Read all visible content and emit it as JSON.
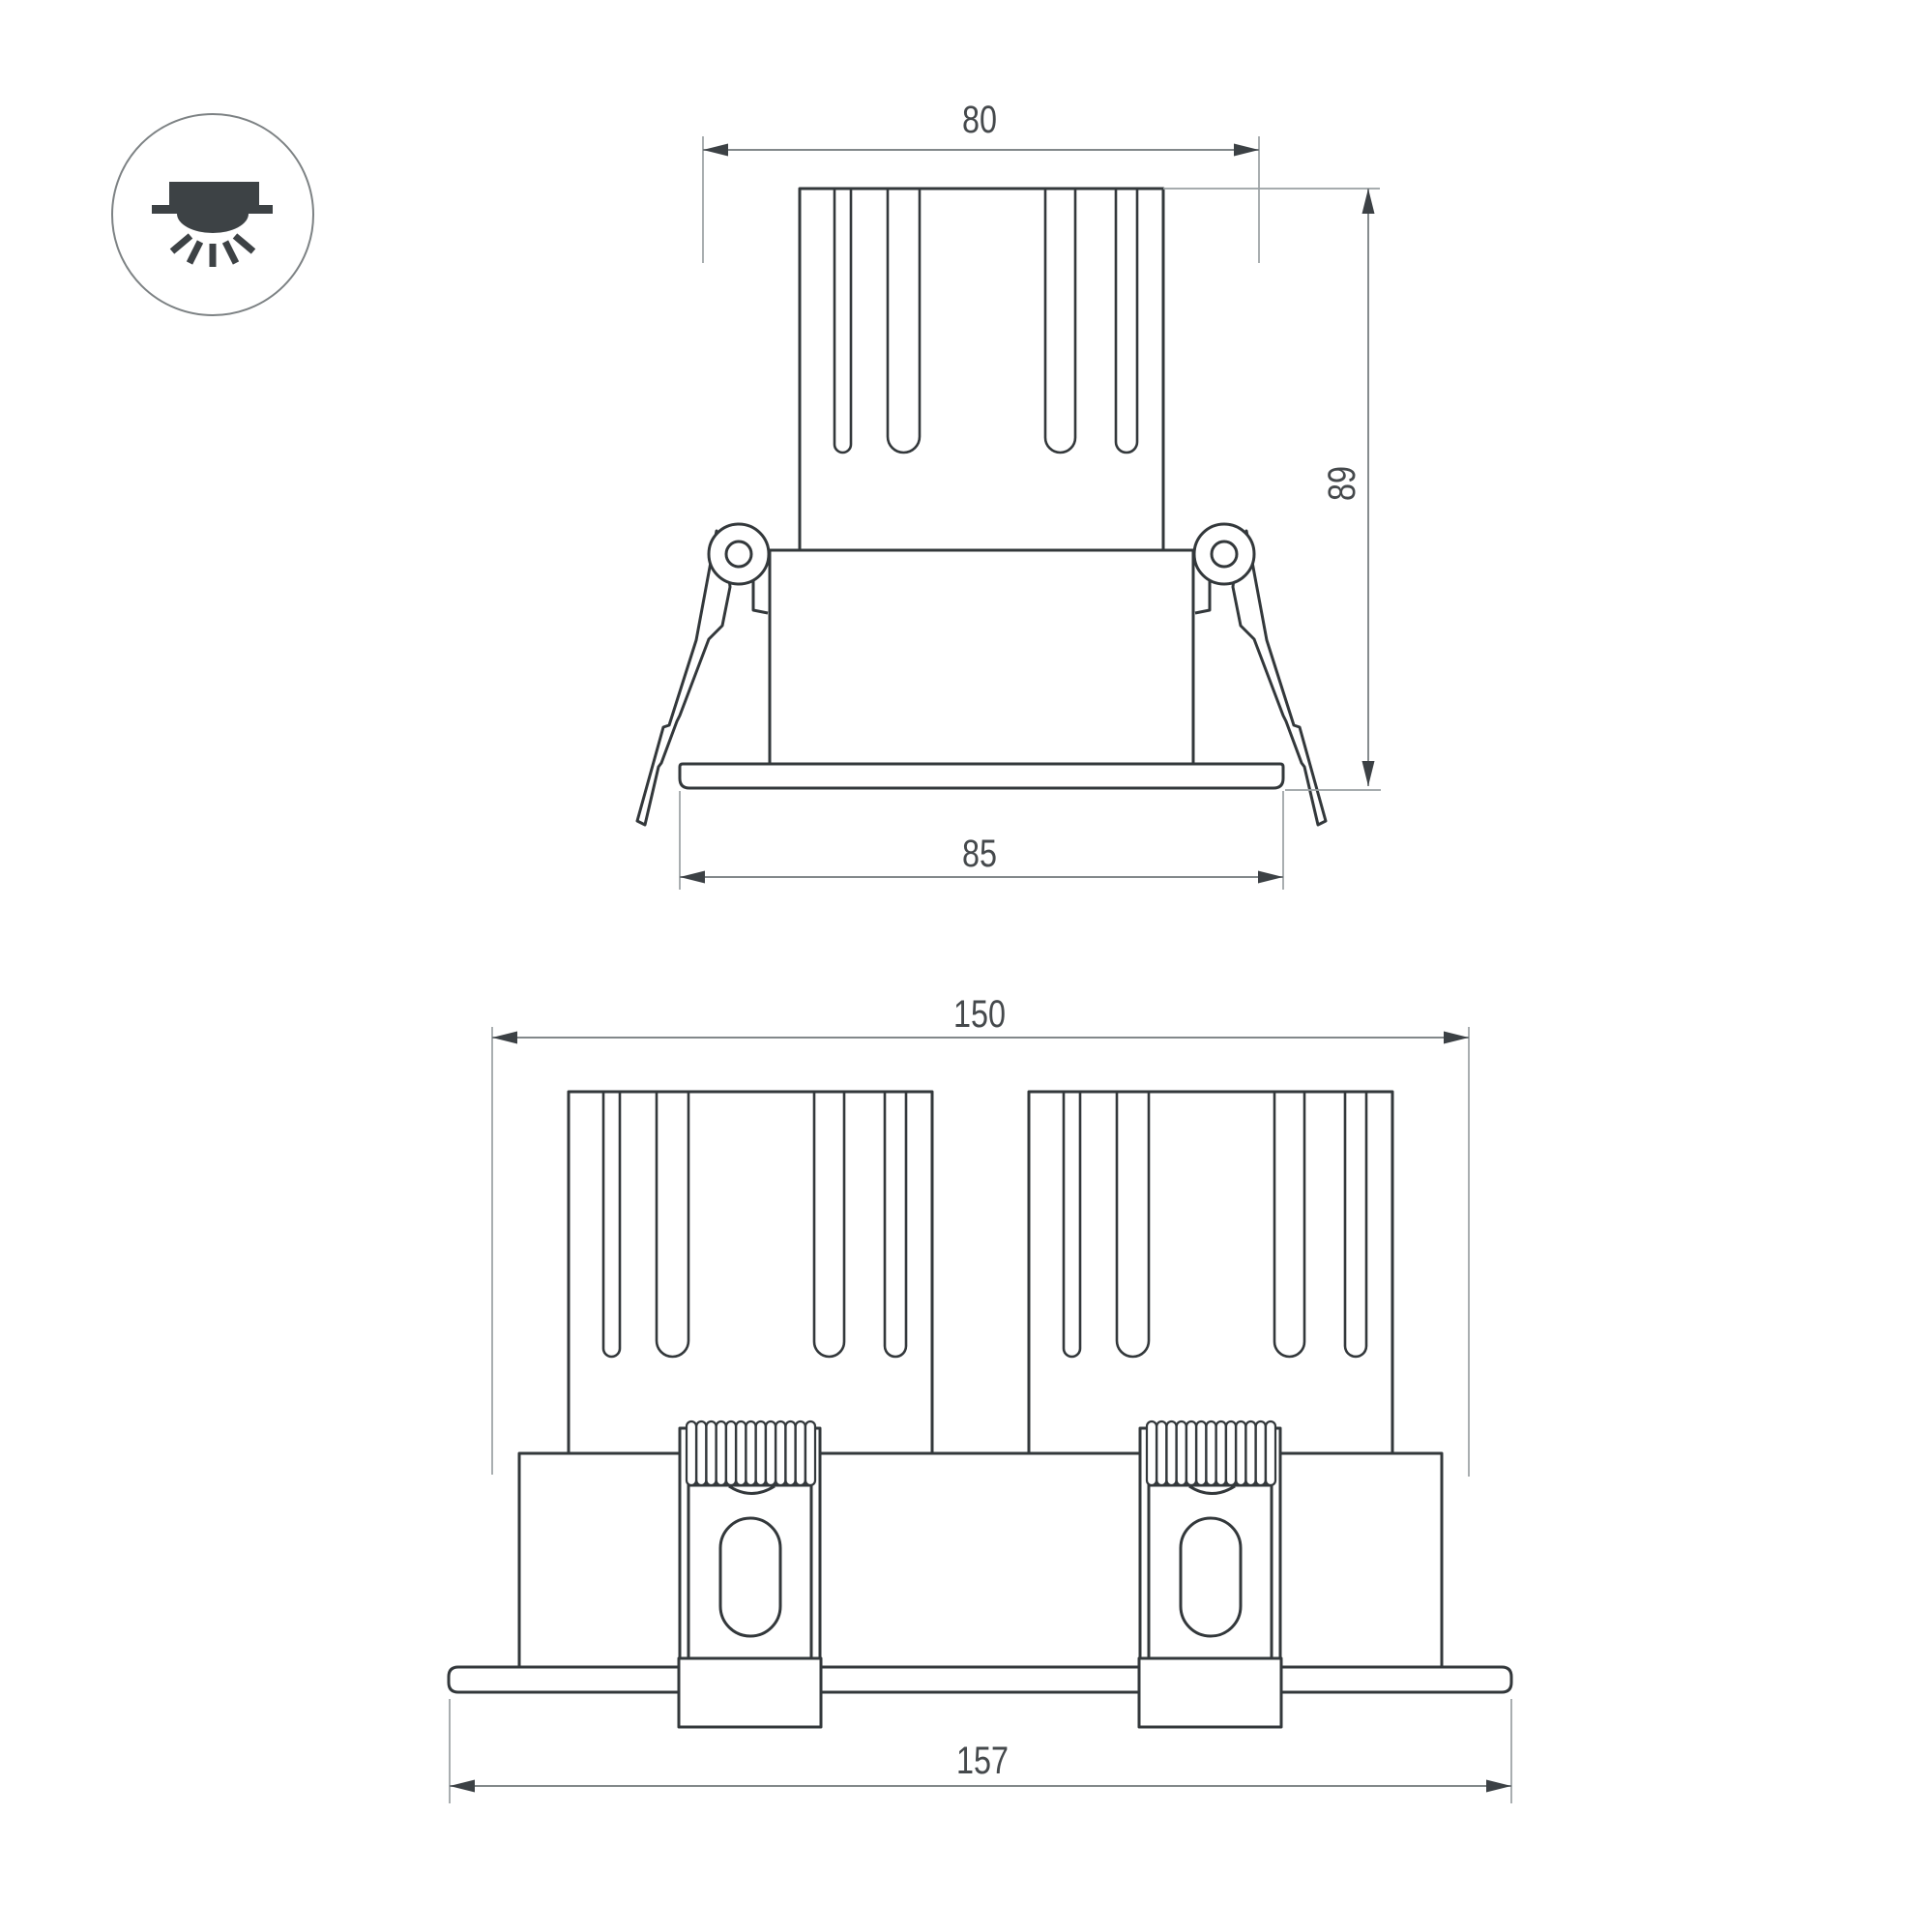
{
  "page": {
    "background": "#ffffff"
  },
  "icon": {
    "name": "recessed-downlight-icon"
  },
  "dimensions": {
    "single_view": {
      "cutout_width": "80",
      "height": "89",
      "flange_width": "85"
    },
    "double_view": {
      "body_width": "150",
      "flange_width": "157"
    }
  },
  "colors": {
    "outline": "#33383b",
    "dim_line": "#71777a",
    "ext_line": "#9aa0a3",
    "arrow": "#3c4145",
    "text": "#45494c",
    "icon_glyph": "#3d4245",
    "icon_ring": "#7d8284"
  }
}
